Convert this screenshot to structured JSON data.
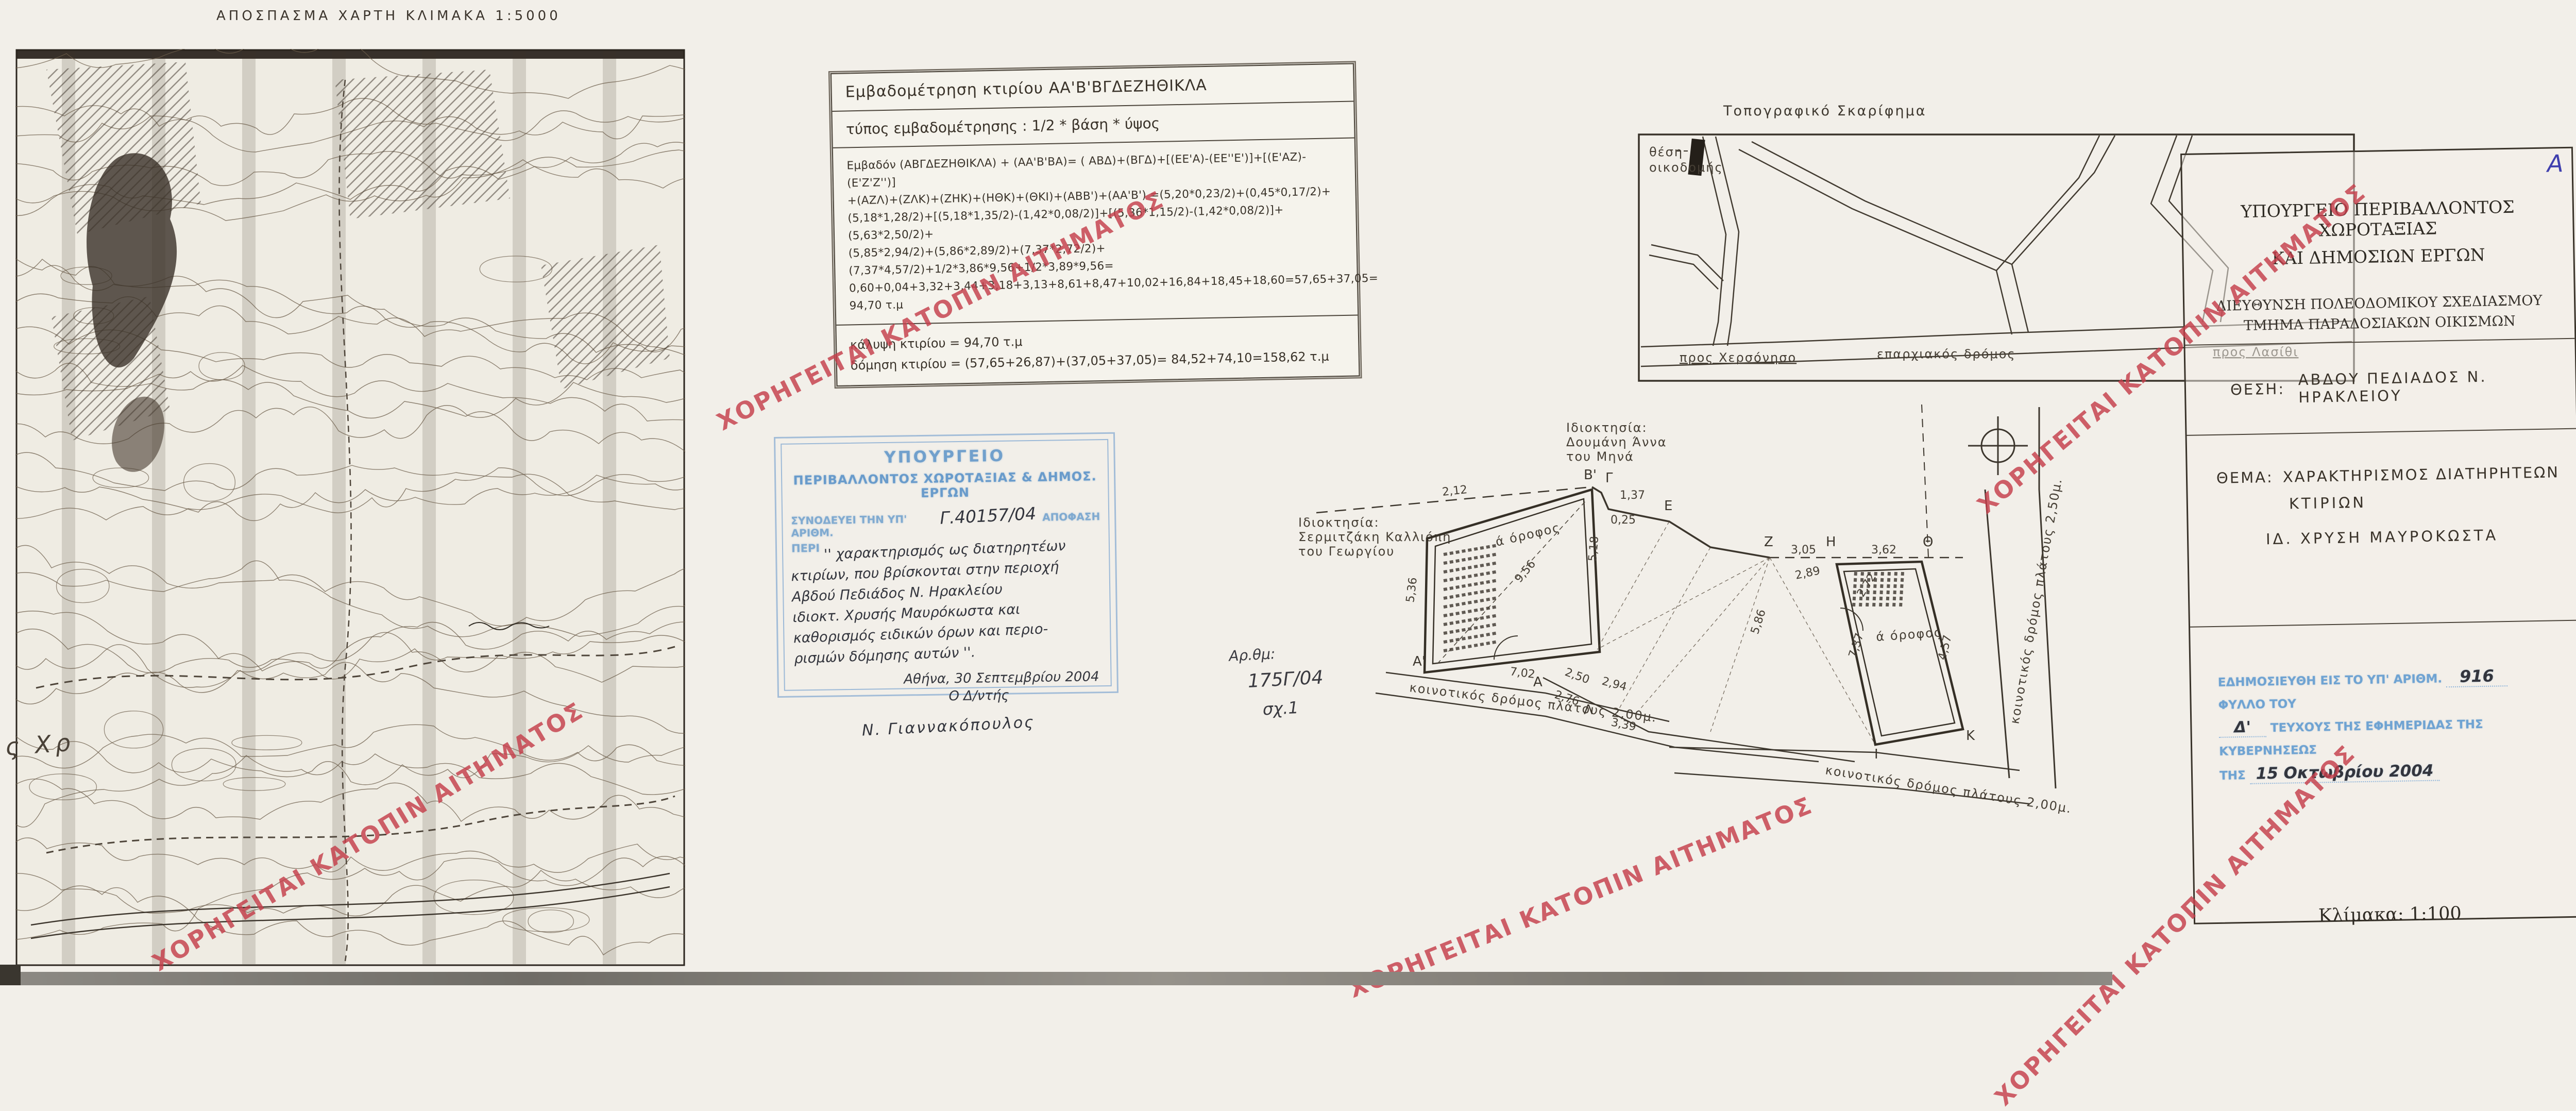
{
  "map_section": {
    "title": "ΑΠΟΣΠΑΣΜΑ ΧΑΡΤΗ ΚΛΙΜΑΚΑ 1:5000",
    "margin_note": "ς Χρ"
  },
  "area_table": {
    "title": "Εμβαδομέτρηση κτιρίου ΑΑ'Β'ΒΓΔΕΖΗΘΙΚΛΑ",
    "formula_type": "τύπος εμβαδομέτρησης : 1/2 * βάση * ύψος",
    "formula_lines": [
      "Εμβαδόν (ΑΒΓΔΕΖΗΘΙΚΛΑ) + (ΑΑ'Β'ΒΑ)= ( ΑΒΔ)+(ΒΓΔ)+[(ΕΕ'Α)-(ΕΕ''Ε')]+[(Ε'ΑΖ)-(Ε'Ζ'Ζ'')]",
      "+(ΑΖΛ)+(ΖΛΚ)+(ΖΗΚ)+(ΗΘΚ)+(ΘΚΙ)+(ΑΒΒ')+(ΑΑ'Β') =(5,20*0,23/2)+(0,45*0,17/2)+",
      "(5,18*1,28/2)+[(5,18*1,35/2)-(1,42*0,08/2)]+[(5,36*1,15/2)-(1,42*0,08/2)]+(5,63*2,50/2)+",
      "(5,85*2,94/2)+(5,86*2,89/2)+(7,37*2,72/2)+(7,37*4,57/2)+1/2*3,86*9,56+1/2*3,89*9,56=",
      "0,60+0,04+3,32+3,44+3,18+3,13+8,61+8,47+10,02+16,84+18,45+18,60=57,65+37,05=",
      "94,70 τ.μ"
    ],
    "coverage_line": "κάλυψη κτιρίου = 94,70 τ.μ",
    "building_line": "δόμηση κτιρίου = (57,65+26,87)+(37,05+37,05)= 84,52+74,10=158,62 τ.μ"
  },
  "approval_stamp": {
    "ministry_line1": "ΥΠΟΥΡΓΕΙΟ",
    "ministry_line2": "ΠΕΡΙΒΑΛΛΟΝΤΟΣ ΧΩΡΟΤΑΞΙΑΣ & ΔΗΜΟΣ. ΕΡΓΩΝ",
    "accompanies_prefix": "ΣΥΝΟΔΕΥΕΙ ΤΗΝ ΥΠ' ΑΡΙΘΜ.",
    "decision_number": "Γ.40157/04",
    "accompanies_suffix": "ΑΠΟΦΑΣΗ",
    "subject_label": "ΠΕΡΙ",
    "subject_lines": [
      "'' χαρακτηρισμός ως διατηρητέων",
      "κτιρίων, που βρίσκονται στην περιοχή",
      "Αβδού Πεδιάδος Ν. Ηρακλείου",
      "ιδιοκτ. Χρυσής Μαυρόκωστα και",
      "καθορισμός ειδικών όρων και περιο-",
      "ρισμών δόμησης αυτών ''."
    ],
    "date_line": "Αθήνα, 30 Σεπτεμβρίου 2004",
    "signer_title": "Ο Δ/ντής",
    "signature": "Ν. Γιαννακόπουλος"
  },
  "file_note": {
    "label": "Αρ.θμ:",
    "number": "175Γ/04",
    "sheet": "σχ.1"
  },
  "topo_sketch": {
    "title": "Τοπογραφικό Σκαρίφημα",
    "building_label_line1": "θέση",
    "building_label_line2": "οικοδομής",
    "road_to_left": "προς Χερσόνησο",
    "road_main": "επαρχιακός δρόμος",
    "road_to_right": "προς Λασίθι"
  },
  "floor_plan": {
    "owner_top_lines": [
      "Ιδιοκτησία:",
      "Δουμάνη Άννα",
      "του Μηνά"
    ],
    "owner_left_lines": [
      "Ιδιοκτησία:",
      "Σερμιτζάκη Καλλιόπη",
      "του Γεωργίου"
    ],
    "floor_label_left": "ά όροφος",
    "floor_label_right": "ά όροφος",
    "road_label_bottom_left": "κοινοτικός δρόμος πλάτους 2,00μ.",
    "road_label_bottom_right": "κοινοτικός δρόμος πλάτους 2,00μ.",
    "road_label_right": "κοινοτικός δρόμος πλάτους 2,50μ.",
    "points": {
      "a": "Α",
      "a1": "Α'",
      "b1": "Β'",
      "g": "Γ",
      "e": "Ε",
      "z": "Ζ",
      "h": "Η",
      "th": "Θ",
      "i": "Ι",
      "k": "Κ",
      "l": "Λ"
    },
    "dims": {
      "d212": "2,12",
      "d137": "1,37",
      "d025": "0,25",
      "d305": "3,05",
      "d362": "3,62",
      "d289": "2,89",
      "d586": "5,86",
      "d518": "5,18",
      "d536": "5,36",
      "d956": "9,56",
      "d702": "7,02",
      "d272": "2,72",
      "d737": "7,37",
      "d457": "4,57",
      "d250": "2,50",
      "d294": "2,94",
      "d276": "2,76",
      "d339": "3,39"
    }
  },
  "title_block": {
    "corner_mark": "Α",
    "ministry_line1": "ΥΠΟΥΡΓΕΙΟ ΠΕΡΙΒΑΛΛΟΝΤΟΣ ΧΩΡΟΤΑΞΙΑΣ",
    "ministry_line2": "ΚΑΙ ΔΗΜΟΣΙΩΝ ΕΡΓΩΝ",
    "directorate": "ΔΙΕΥΘΥΝΣΗ ΠΟΛΕΟΔΟΜΙΚΟΥ ΣΧΕΔΙΑΣΜΟΥ",
    "department": "ΤΜΗΜΑ ΠΑΡΑΔΟΣΙΑΚΩΝ ΟΙΚΙΣΜΩΝ",
    "location_label": "ΘΕΣΗ:",
    "location_value": "ΑΒΔΟΥ ΠΕΔΙΑΔΟΣ   Ν. ΗΡΑΚΛΕΙΟΥ",
    "subject_label": "ΘΕΜΑ:",
    "subject_value_line1": "ΧΑΡΑΚΤΗΡΙΣΜΟΣ ΔΙΑΤΗΡΗΤΕΩΝ",
    "subject_value_line2": "ΚΤΙΡΙΩΝ",
    "owner_value": "ΙΔ. ΧΡΥΣΗ ΜΑΥΡΟΚΩΣΤΑ",
    "publication_stamp": {
      "prefix": "ΕΔΗΜΟΣΙΕΥΘΗ ΕΙΣ ΤΟ ΥΠ' ΑΡΙΘΜ.",
      "number": "916",
      "middle": "ΦΥΛΛΟ ΤΟΥ",
      "issue": "Δ'",
      "suffix": "ΤΕΥΧΟΥΣ ΤΗΣ ΕΦΗΜΕΡΙΔΑΣ ΤΗΣ ΚΥΒΕΡΝΗΣΕΩΣ",
      "date_prefix": "ΤΗΣ",
      "date_value": "15 Οκτωβρίου 2004"
    },
    "scale": "Κλίμακα: 1:100"
  },
  "watermark": {
    "text": "ΧΟΡΗΓΕΙΤΑΙ ΚΑΤΟΠΙΝ ΑΙΤΗΜΑΤΟΣ",
    "color": "#c2424e"
  },
  "colors": {
    "paper": "#f1eee8",
    "ink": "#393229",
    "stamp_blue": "#5b93c8",
    "corner_ink_blue": "#3f3fae",
    "scan_edge_blue": "#3c78c2",
    "watermark_red": "#c2424e"
  }
}
